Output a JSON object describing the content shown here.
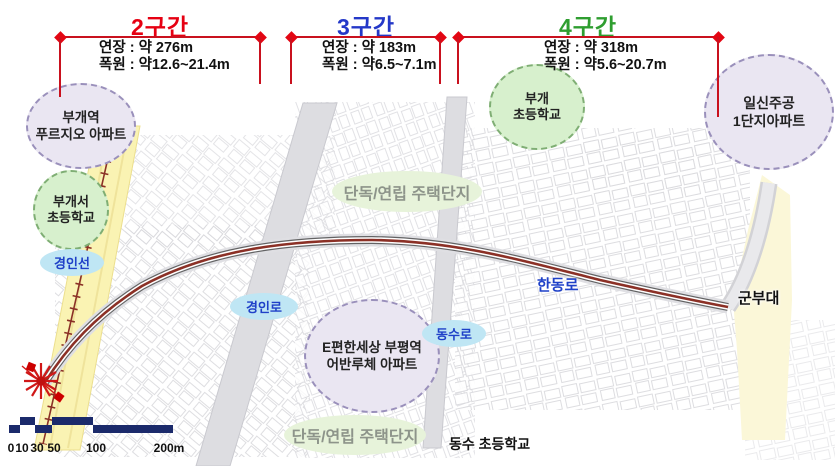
{
  "header": {
    "sections": [
      {
        "title": "2구간",
        "length": "연장 : 약 276m",
        "width": "폭원 : 약12.6~21.4m"
      },
      {
        "title": "3구간",
        "length": "연장 : 약 183m",
        "width": "폭원 : 약6.5~7.1m"
      },
      {
        "title": "4구간",
        "length": "연장 : 약 318m",
        "width": "폭원 : 약5.6~20.7m"
      }
    ]
  },
  "landmarks": {
    "bugae_station_apartment": {
      "line1": "부개역",
      "line2": "푸르지오 아파트"
    },
    "bugaeseo_elementary": {
      "line1": "부개서",
      "line2": "초등학교"
    },
    "bugae_elementary": {
      "line1": "부개",
      "line2": "초등학교"
    },
    "ilsin_jugong_apartment": {
      "line1": "일신주공",
      "line2": "1단지아파트"
    },
    "epyeonhansesang_apartment": {
      "line1": "E편한세상 부평역",
      "line2": "어반루체 아파트"
    }
  },
  "roads": {
    "gyeongin_line": "경인선",
    "gyeongin_ro": "경인로",
    "dongsu_ro": "동수로",
    "handong_ro": "한동로"
  },
  "areas": {
    "housing_top": "단독/연립 주택단지",
    "housing_bottom": "단독/연립 주택단지",
    "military_base": "군부대",
    "dongsu_elementary": "동수 초등학교"
  },
  "scalebar": {
    "ticks": [
      "0",
      "10",
      "30",
      "50",
      "100",
      "200m"
    ]
  },
  "colors": {
    "section2": "#e60012",
    "section3": "#2438c8",
    "section4": "#2f9e30",
    "dimension_line": "#c9111e",
    "scalebar": "#1b2a6b",
    "route": "#8b3026",
    "rail_corridor": "#faf3b3",
    "military_area": "#fbf7d8"
  }
}
